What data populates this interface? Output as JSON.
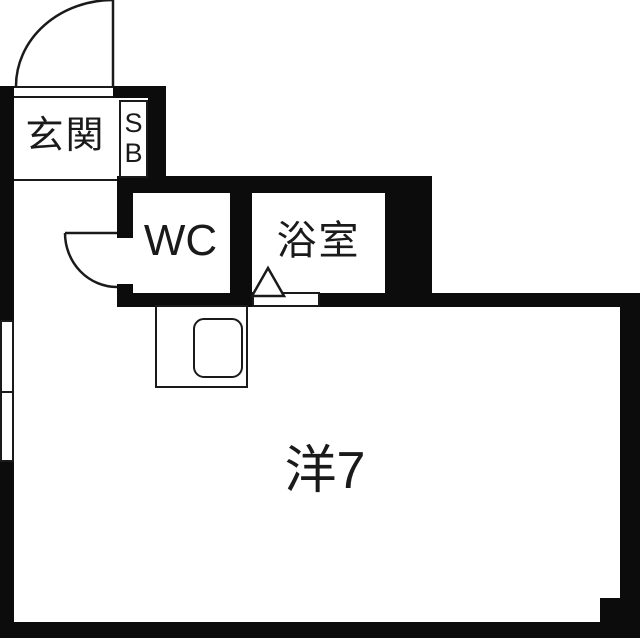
{
  "colors": {
    "wall": "#0c0c0c",
    "line": "#1a1a1a",
    "floor": "#ffffff",
    "background": "#fefefe"
  },
  "rooms": {
    "genkan": {
      "label": "玄関"
    },
    "shoe_box": {
      "line1": "S",
      "line2": "B"
    },
    "wc": {
      "label": "WC"
    },
    "bath": {
      "label": "浴室"
    },
    "living": {
      "label": "洋7"
    }
  },
  "shapes": {
    "entrance_door": "swing-door-arc",
    "wc_door": "swing-door-arc",
    "bath_door_marker": "triangle",
    "kitchen": "counter-with-sink",
    "window": "double-pane-window"
  }
}
